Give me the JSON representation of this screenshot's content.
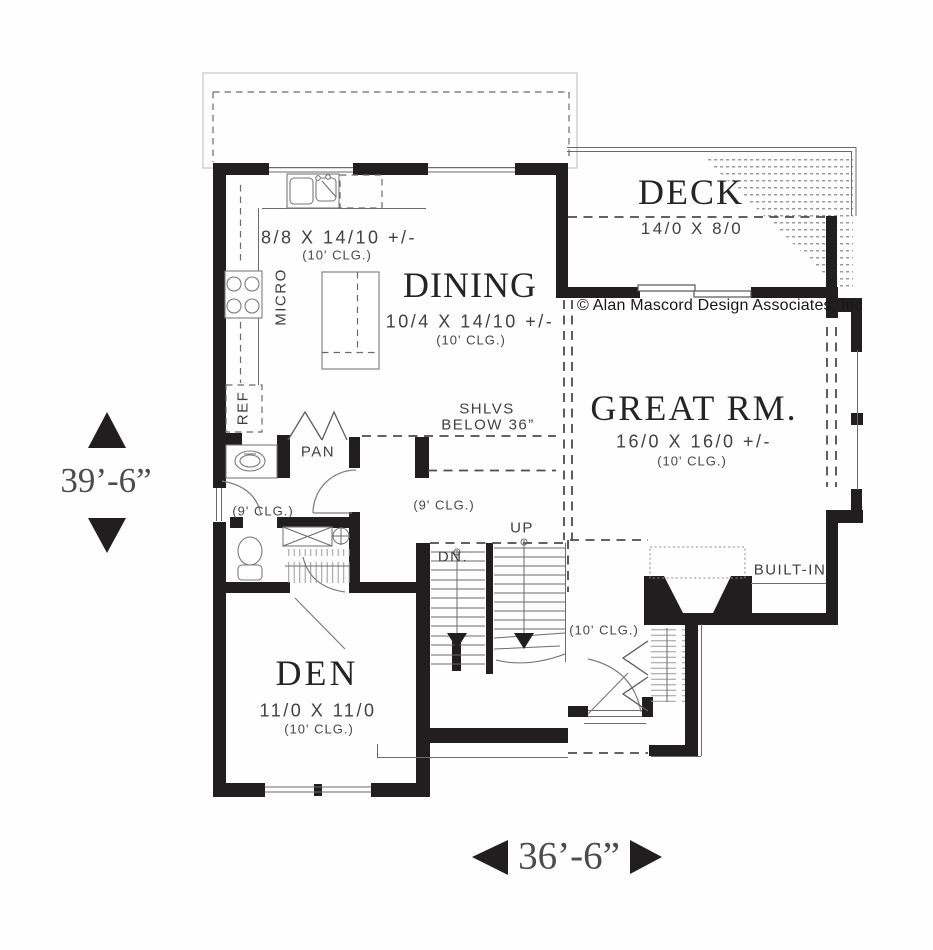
{
  "rooms": {
    "kitchen": {
      "dims": "8/8 X 14/10 +/-",
      "ceiling": "(10' CLG.)",
      "micro": "MICRO",
      "ref": "REF",
      "pantry": "PAN"
    },
    "dining": {
      "name": "DINING",
      "dims": "10/4 X 14/10 +/-",
      "ceiling": "(10' CLG.)"
    },
    "deck": {
      "name": "DECK",
      "dims": "14/0 X 8/0"
    },
    "great_room": {
      "name": "GREAT RM.",
      "dims": "16/0 X 16/0 +/-",
      "ceiling": "(10' CLG.)",
      "built_in": "BUILT-IN"
    },
    "den": {
      "name": "DEN",
      "dims": "11/0 X 11/0",
      "ceiling": "(10' CLG.)"
    },
    "hall": {
      "ceiling_left": "(9' CLG.)",
      "ceiling_right": "(9' CLG.)"
    },
    "entry": {
      "ceiling": "(10' CLG.)"
    },
    "stairs": {
      "up": "UP",
      "down": "DN."
    },
    "shelves": {
      "line1": "SHLVS",
      "line2": "BELOW 36”"
    }
  },
  "dimensions": {
    "vertical": "39’-6”",
    "horizontal": "36’-6”"
  },
  "copyright": "© Alan Mascord Design Associates, Inc",
  "colors": {
    "wall": "#211e1f",
    "thin_line": "#6b6b6b",
    "text": "#3a3a3a",
    "roof_line": "#c6c6c6"
  }
}
